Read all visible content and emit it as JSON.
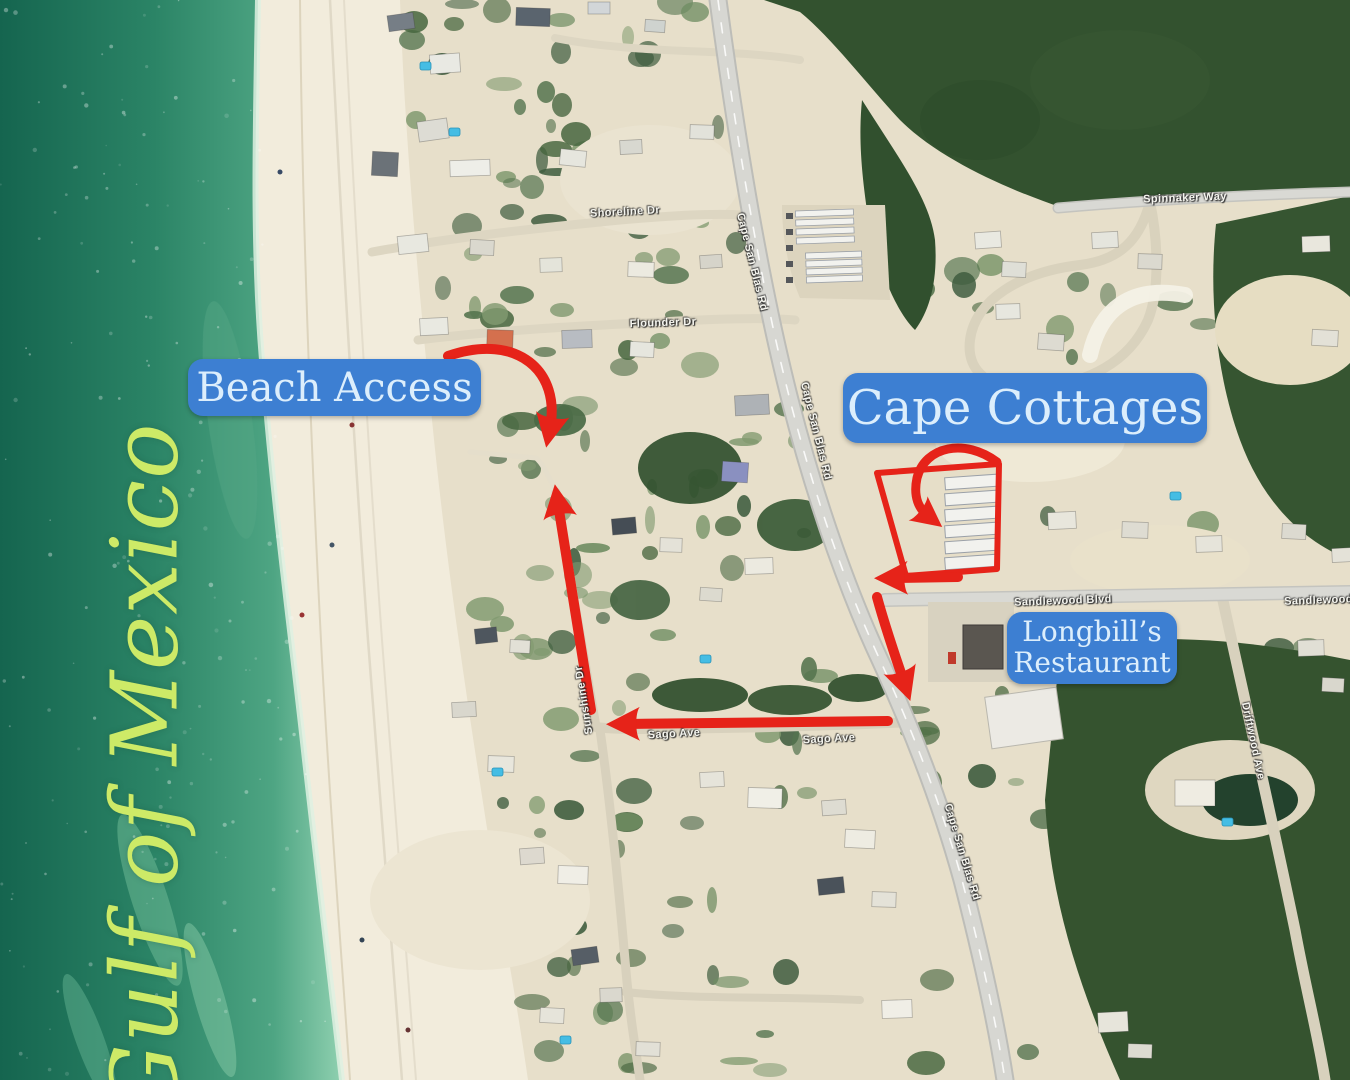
{
  "annotations": {
    "gulf_label": "Gulf of Mexico",
    "beach_access": "Beach Access",
    "cape_cottages": "Cape Cottages",
    "longbills": {
      "line1": "Longbill’s",
      "line2": "Restaurant"
    }
  },
  "road_labels": {
    "spinnaker_way": "Spinnaker Way",
    "shoreline_dr": "Shoreline Dr",
    "flounder_dr": "Flounder Dr",
    "cape_san_blas_rd_1": "Cape San Blas Rd",
    "cape_san_blas_rd_2": "Cape San Blas Rd",
    "cape_san_blas_rd_3": "Cape San Blas Rd",
    "sandlewood_blvd_1": "Sandlewood Blvd",
    "sandlewood_blvd_2": "Sandlewood Blvd",
    "sago_ave_1": "Sago Ave",
    "sago_ave_2": "Sago Ave",
    "driftwood_ave": "Driftwood Ave",
    "sunshine_dr": "Sunshine Dr"
  },
  "colors": {
    "callout_bg": "#3d7fd2",
    "callout_text": "#dceefc",
    "route_red": "#e62319",
    "gulf_text": "#cdea67",
    "water_deep": "#15654f",
    "water_shore": "#6fbd97",
    "sand": "#f2ecdc",
    "forest": "#33522f",
    "road": "#d7d7d2"
  }
}
